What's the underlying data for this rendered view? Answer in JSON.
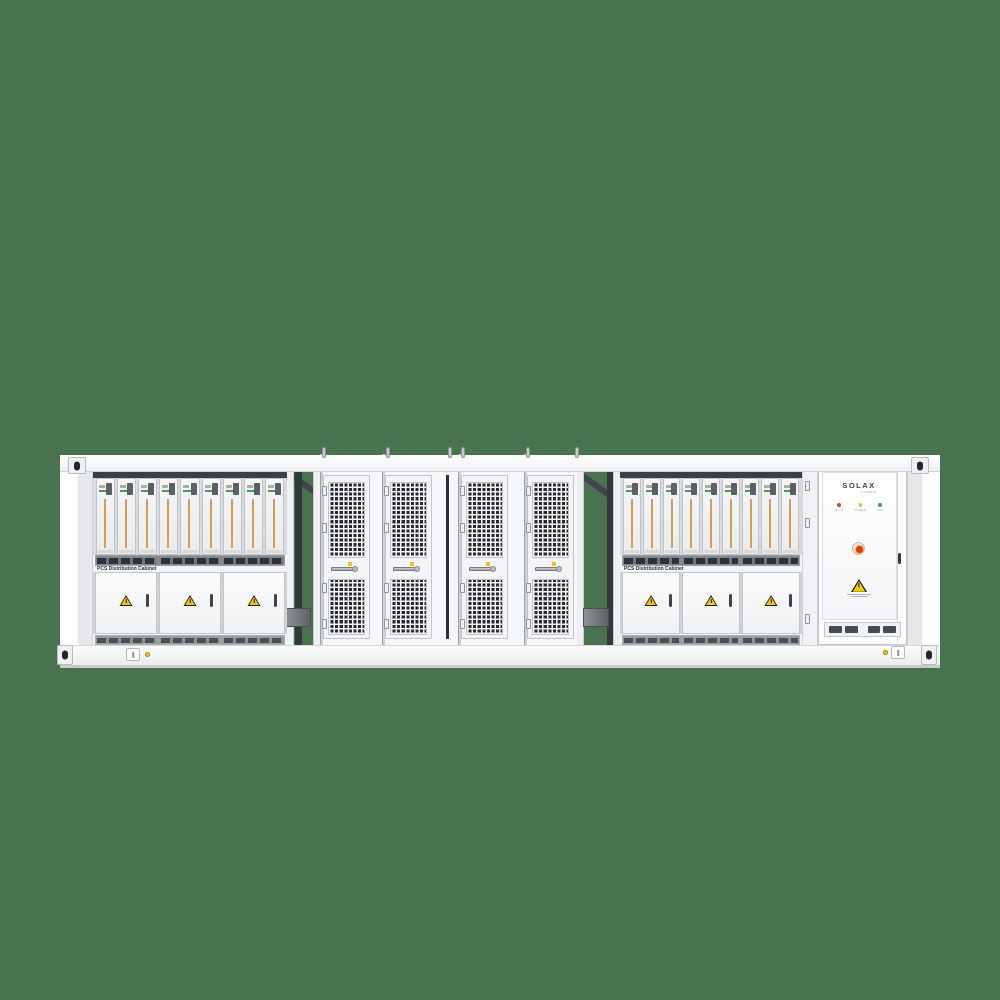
{
  "scene": {
    "background_color": "#48734E",
    "subject": "Containerized battery energy storage system, front view product render"
  },
  "branding": {
    "logo": "SOLAX",
    "logo_sub": "POWER"
  },
  "racks": {
    "left": {
      "label": "PCS Distribution Cabinet",
      "modules": 9,
      "doors": 3
    },
    "right": {
      "label": "PCS Distribution Cabinet",
      "modules": 9,
      "doors": 3
    }
  },
  "mesh": {
    "doors": 4
  },
  "cabinet": {
    "leds": [
      {
        "label": "FAULT",
        "color": "#D84B3A"
      },
      {
        "label": "POWER",
        "color": "#E9C41B"
      },
      {
        "label": "RUN",
        "color": "#49A94F"
      }
    ]
  },
  "colors": {
    "container_body": "#F5F6F7",
    "grille_dark": "#26292D",
    "module_stripe_orange": "#D69C58",
    "module_led_green": "#3FA24A",
    "warning_yellow": "#F2C40E",
    "frame_dark": "#3B4046"
  }
}
